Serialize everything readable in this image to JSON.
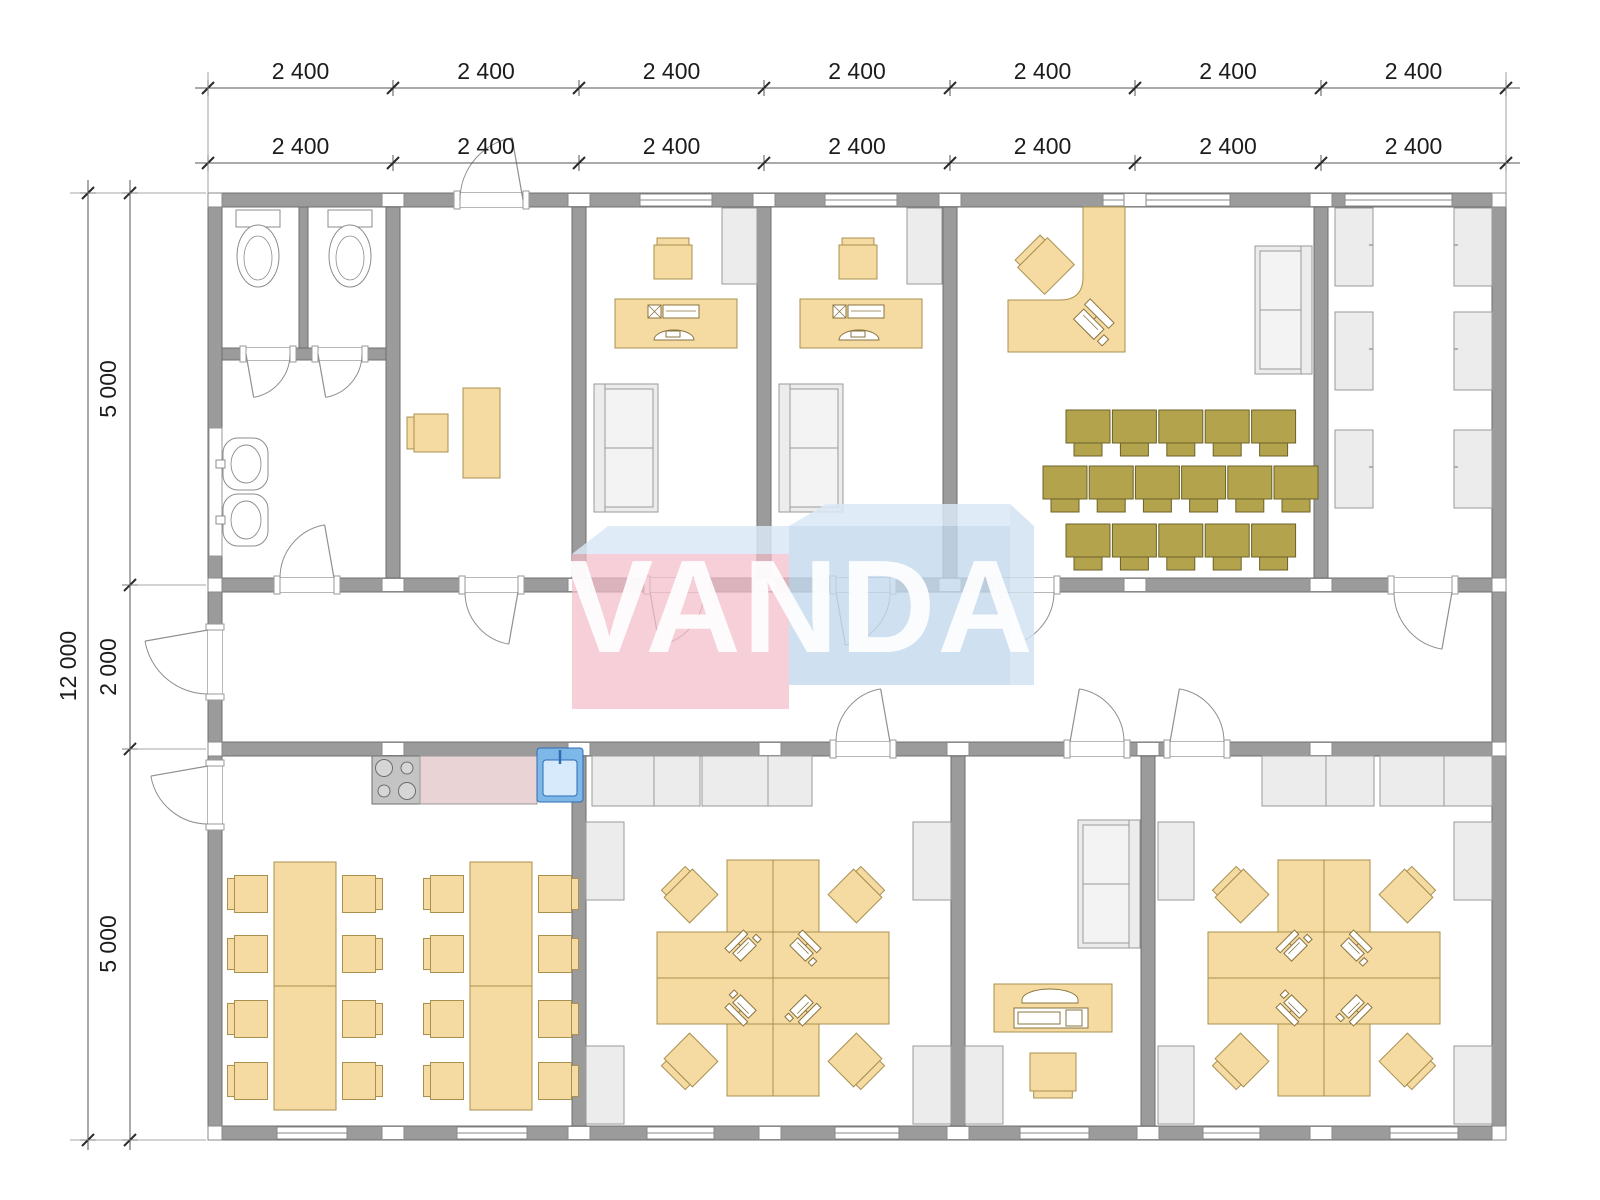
{
  "page": {
    "background": "#ffffff"
  },
  "watermark": {
    "text": "VANDA",
    "pink": "#f3bdc9",
    "blue": "#c3d9ec",
    "top_face": "#d9e9f6",
    "side_face": "#cfe0f0",
    "text_color": "#ffffff"
  },
  "dimensions": {
    "top_outer": [
      "2 400",
      "2 400",
      "2 400",
      "2 400",
      "2 400",
      "2 400",
      "2 400"
    ],
    "top_inner": [
      "2 400",
      "2 400",
      "2 400",
      "2 400",
      "2 400",
      "2 400",
      "2 400"
    ],
    "left_overall": "12 000",
    "left_segments": [
      "5 000",
      "2 000",
      "5 000"
    ]
  },
  "colors": {
    "wall_fill": "#9b9b9b",
    "wall_edge": "#6f6f6f",
    "opening_fill": "#ffffff",
    "furniture_tan": "#f5daa2",
    "furniture_tan_edge": "#a8904e",
    "equipment_edge": "#8a7440",
    "chair_olive": "#b2a34c",
    "chair_olive_edge": "#6c6228",
    "gray_fill": "#ececec",
    "gray_inner": "#f3f3f3",
    "gray_edge": "#9a9a9a",
    "fixture_edge": "#8c8c8c",
    "door_arc": "#8f8f8f",
    "counter_pink": "#ead3d5",
    "stove_fill": "#c4c4c4",
    "burner_fill": "#d6d6d6",
    "sink_fill": "#7db8e8",
    "sink_edge": "#2e6cb5",
    "sink_inner": "#d6eafc",
    "dim_line": "#555555",
    "dim_text": "#1c1c1c"
  }
}
